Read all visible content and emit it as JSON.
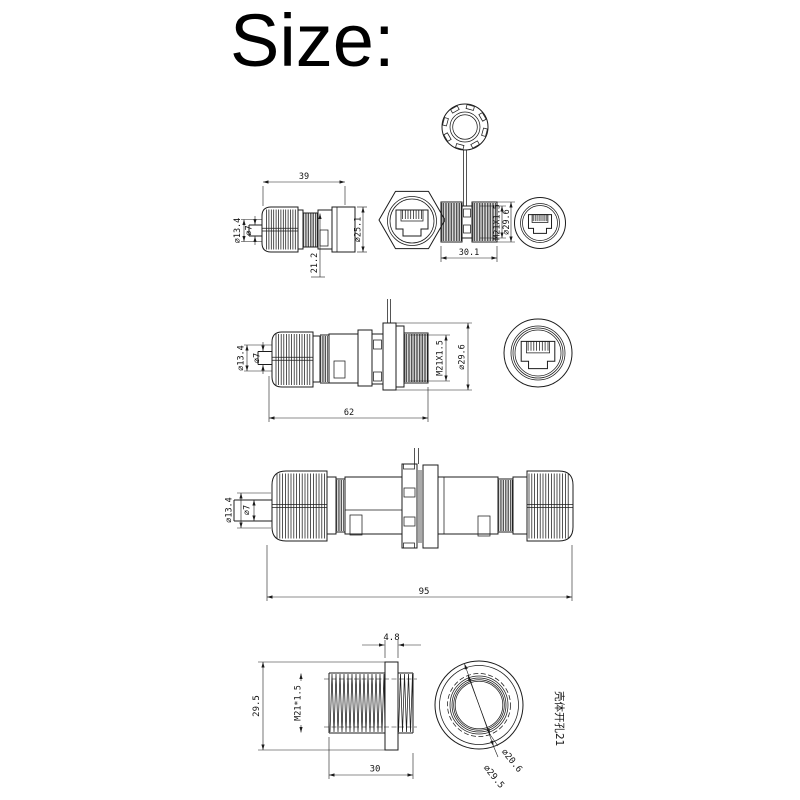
{
  "title": "Size:",
  "colors": {
    "background": "#ffffff",
    "line": "#1c1c1c",
    "text": "#141414"
  },
  "views": {
    "plug_side": {
      "dim_length": "39",
      "dim_cable_clamp": "⌀13.4",
      "dim_cable": "⌀7",
      "dim_body": "⌀25.1",
      "dim_rear": "21.2"
    },
    "socket_side": {
      "dim_thread": "M21X1.5",
      "dim_flange": "⌀29.6",
      "dim_length": "30.1"
    },
    "assembly_side": {
      "dim_cable_clamp": "⌀13.4",
      "dim_cable": "⌀7",
      "dim_thread": "M21X1.5",
      "dim_flange": "⌀29.6",
      "dim_length": "62"
    },
    "coupler_side": {
      "dim_cable_clamp": "⌀13.4",
      "dim_cable": "⌀7",
      "dim_length": "95"
    },
    "gland_thread": {
      "dim_flange_width": "4.8",
      "dim_flange_od": "29.5",
      "dim_thread": "M21*1.5",
      "dim_length": "30"
    },
    "panel_cutout": {
      "dim_hole": "⌀20.6",
      "dim_outer": "⌀29.5",
      "note": "壳体开孔21"
    }
  }
}
